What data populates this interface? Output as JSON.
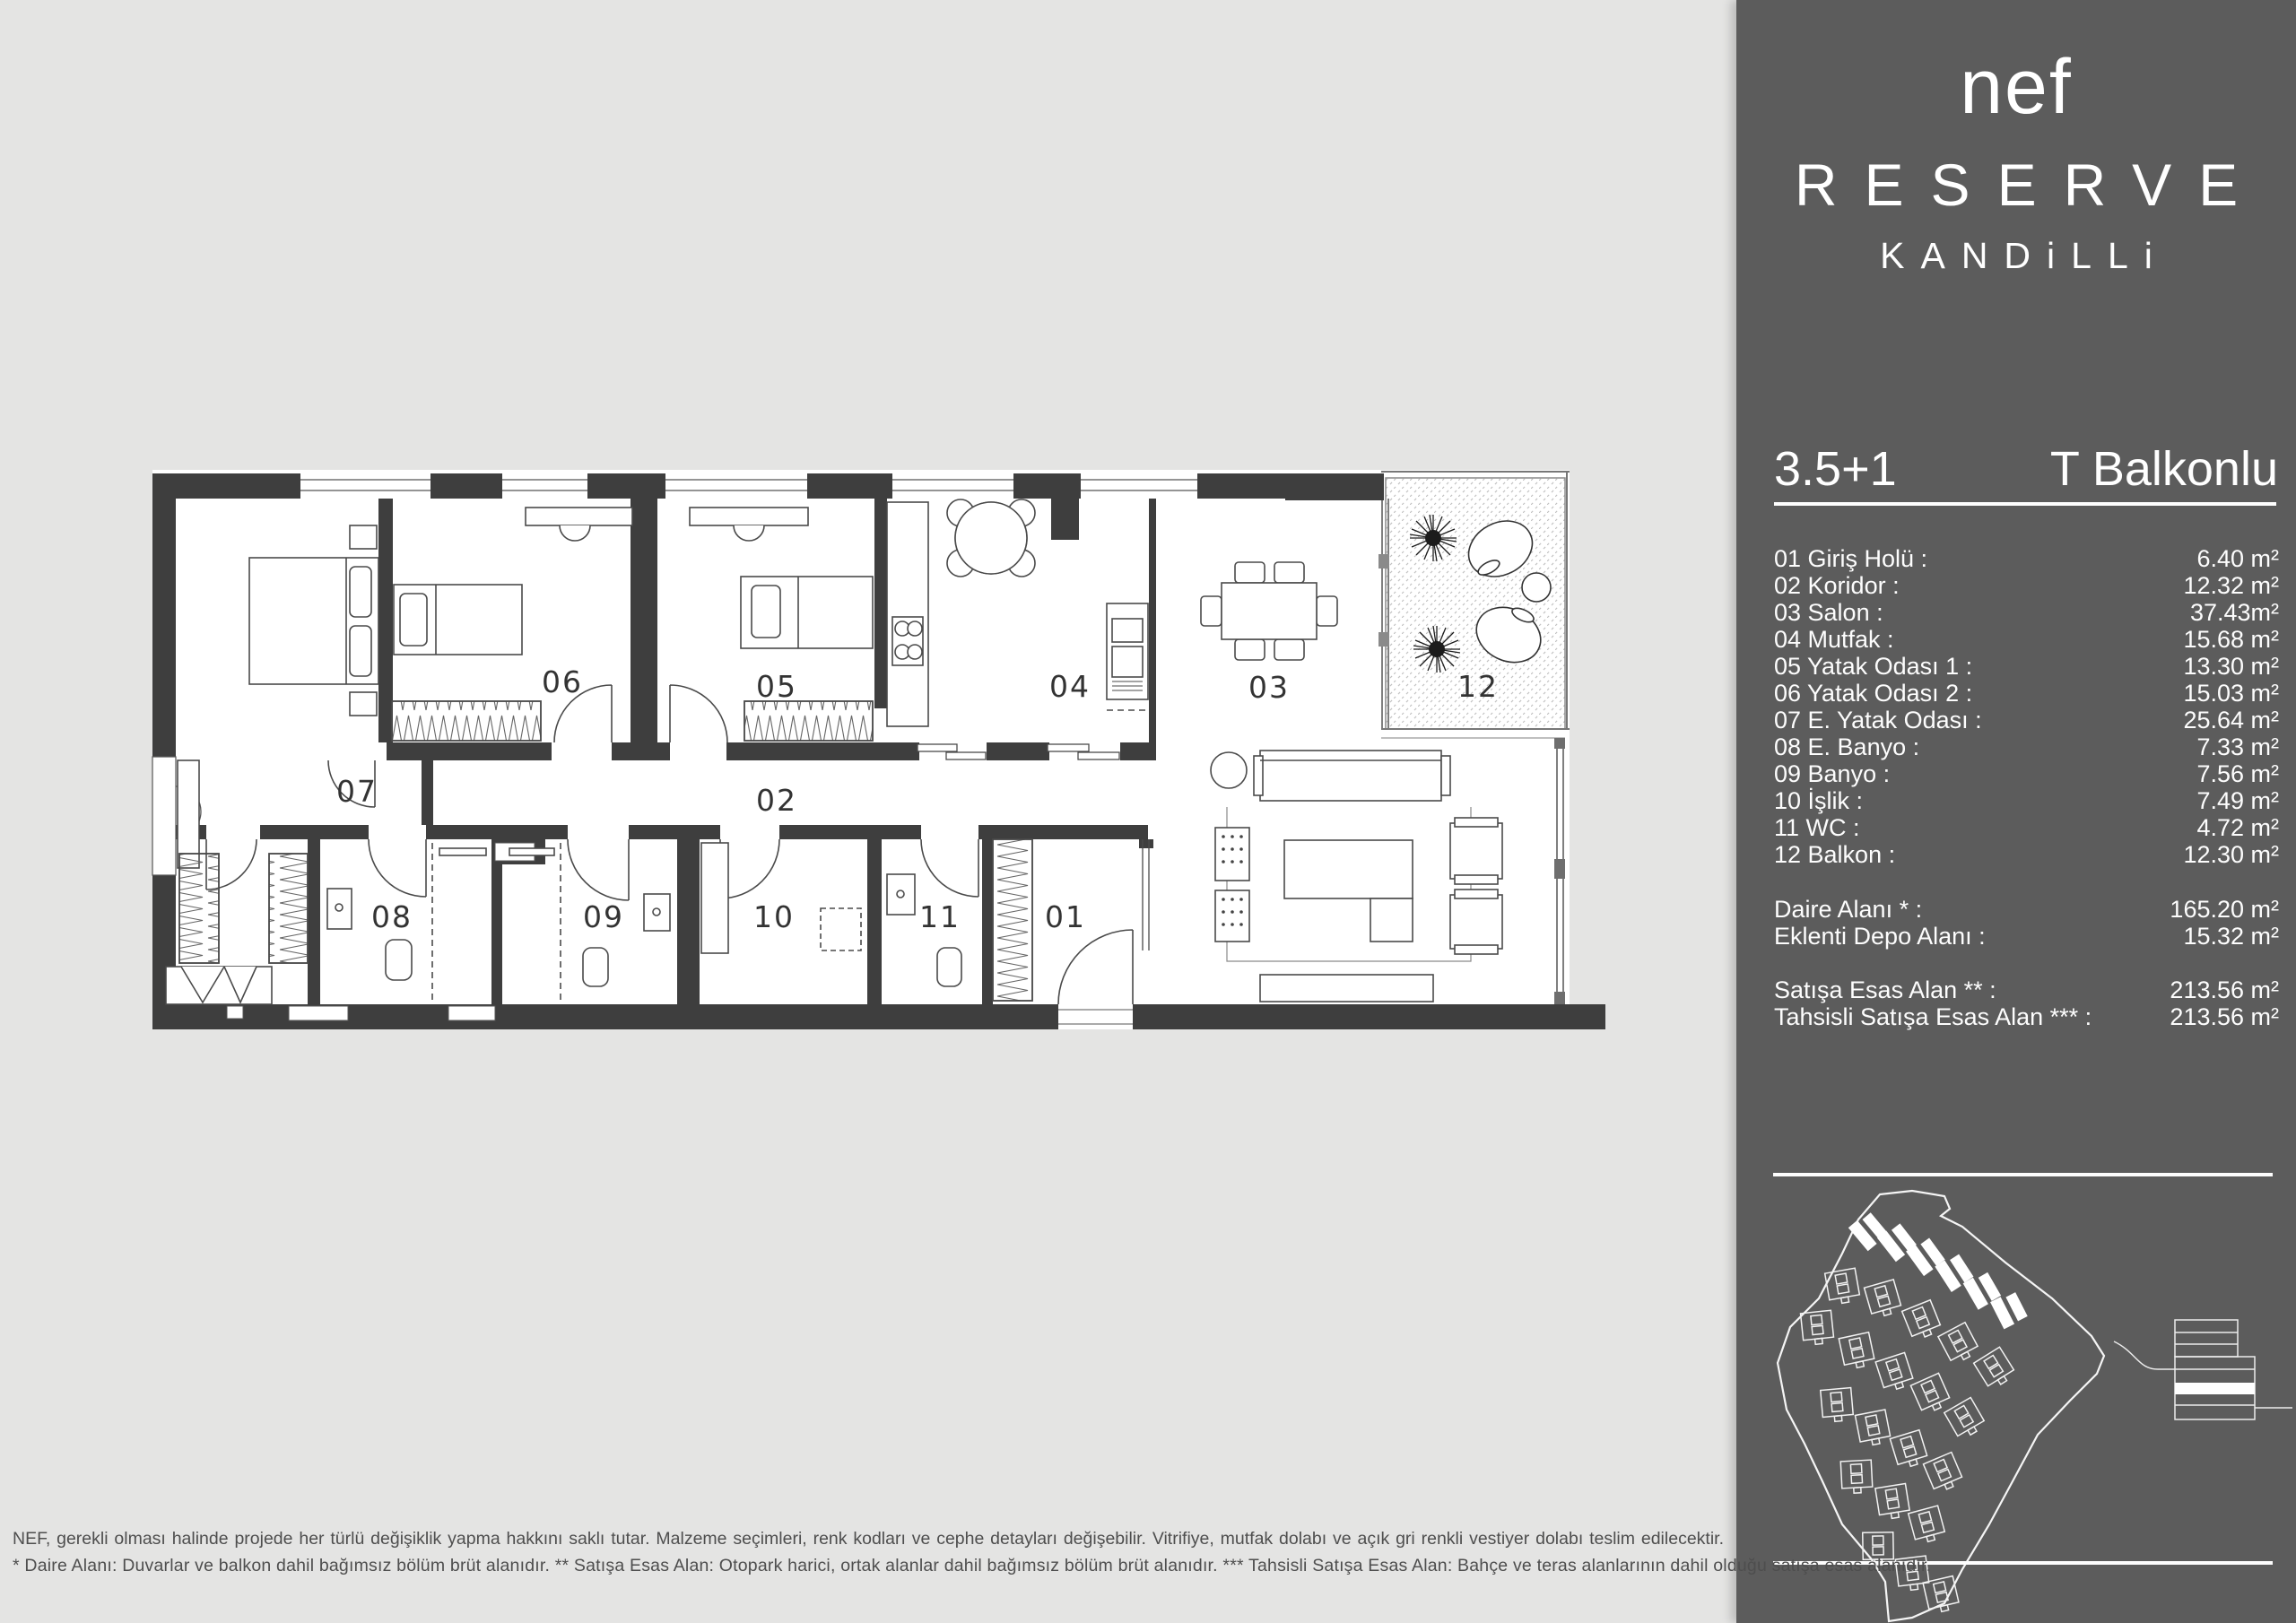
{
  "brand": {
    "logo": "nef",
    "name": "RESERVE",
    "location": "KANDiLLi"
  },
  "unit": {
    "type": "3.5+1",
    "variant": "T Balkonlu"
  },
  "rooms": [
    {
      "label": "01 Giriş Holü :",
      "area": "6.40 m²"
    },
    {
      "label": "02 Koridor :",
      "area": "12.32 m²"
    },
    {
      "label": "03 Salon :",
      "area": "37.43m²"
    },
    {
      "label": "04 Mutfak :",
      "area": "15.68 m²"
    },
    {
      "label": "05 Yatak Odası 1 :",
      "area": "13.30 m²"
    },
    {
      "label": "06 Yatak Odası 2 :",
      "area": "15.03 m²"
    },
    {
      "label": "07 E. Yatak Odası :",
      "area": "25.64 m²"
    },
    {
      "label": "08 E. Banyo :",
      "area": "7.33 m²"
    },
    {
      "label": "09 Banyo :",
      "area": "7.56 m²"
    },
    {
      "label": "10 İşlik :",
      "area": "7.49 m²"
    },
    {
      "label": "11 WC :",
      "area": "4.72 m²"
    },
    {
      "label": "12 Balkon :",
      "area": "12.30 m²"
    }
  ],
  "totals": [
    {
      "label": "Daire Alanı * :",
      "area": "165.20 m²"
    },
    {
      "label": "Eklenti Depo Alanı :",
      "area": "15.32 m²"
    }
  ],
  "sales": [
    {
      "label": "Satışa Esas Alan ** :",
      "area": "213.56 m²"
    },
    {
      "label": "Tahsisli Satışa Esas Alan *** :",
      "area": "213.56 m²"
    }
  ],
  "plan": {
    "labels": {
      "r01": "01",
      "r02": "02",
      "r03": "03",
      "r04": "04",
      "r05": "05",
      "r06": "06",
      "r07": "07",
      "r08": "08",
      "r09": "09",
      "r10": "10",
      "r11": "11",
      "r12": "12"
    }
  },
  "disclaimer": {
    "line1": "NEF, gerekli olması halinde projede her türlü değişiklik yapma hakkını saklı tutar. Malzeme seçimleri, renk kodları ve cephe detayları değişebilir. Vitrifiye, mutfak dolabı ve açık gri renkli vestiyer dolabı teslim edilecektir.",
    "line2": "* Daire Alanı: Duvarlar ve balkon dahil bağımsız bölüm brüt alanıdır.  ** Satışa Esas Alan: Otopark harici, ortak alanlar dahil bağımsız bölüm brüt alanıdır.   *** Tahsisli Satışa Esas Alan: Bahçe ve teras alanlarının dahil olduğu satışa esas alanıdır."
  },
  "colors": {
    "background": "#e4e4e3",
    "sidebar": "#5c5c5c",
    "wall": "#3e3e3e",
    "text_light": "#ffffff",
    "text_muted": "#4e4e4e"
  }
}
